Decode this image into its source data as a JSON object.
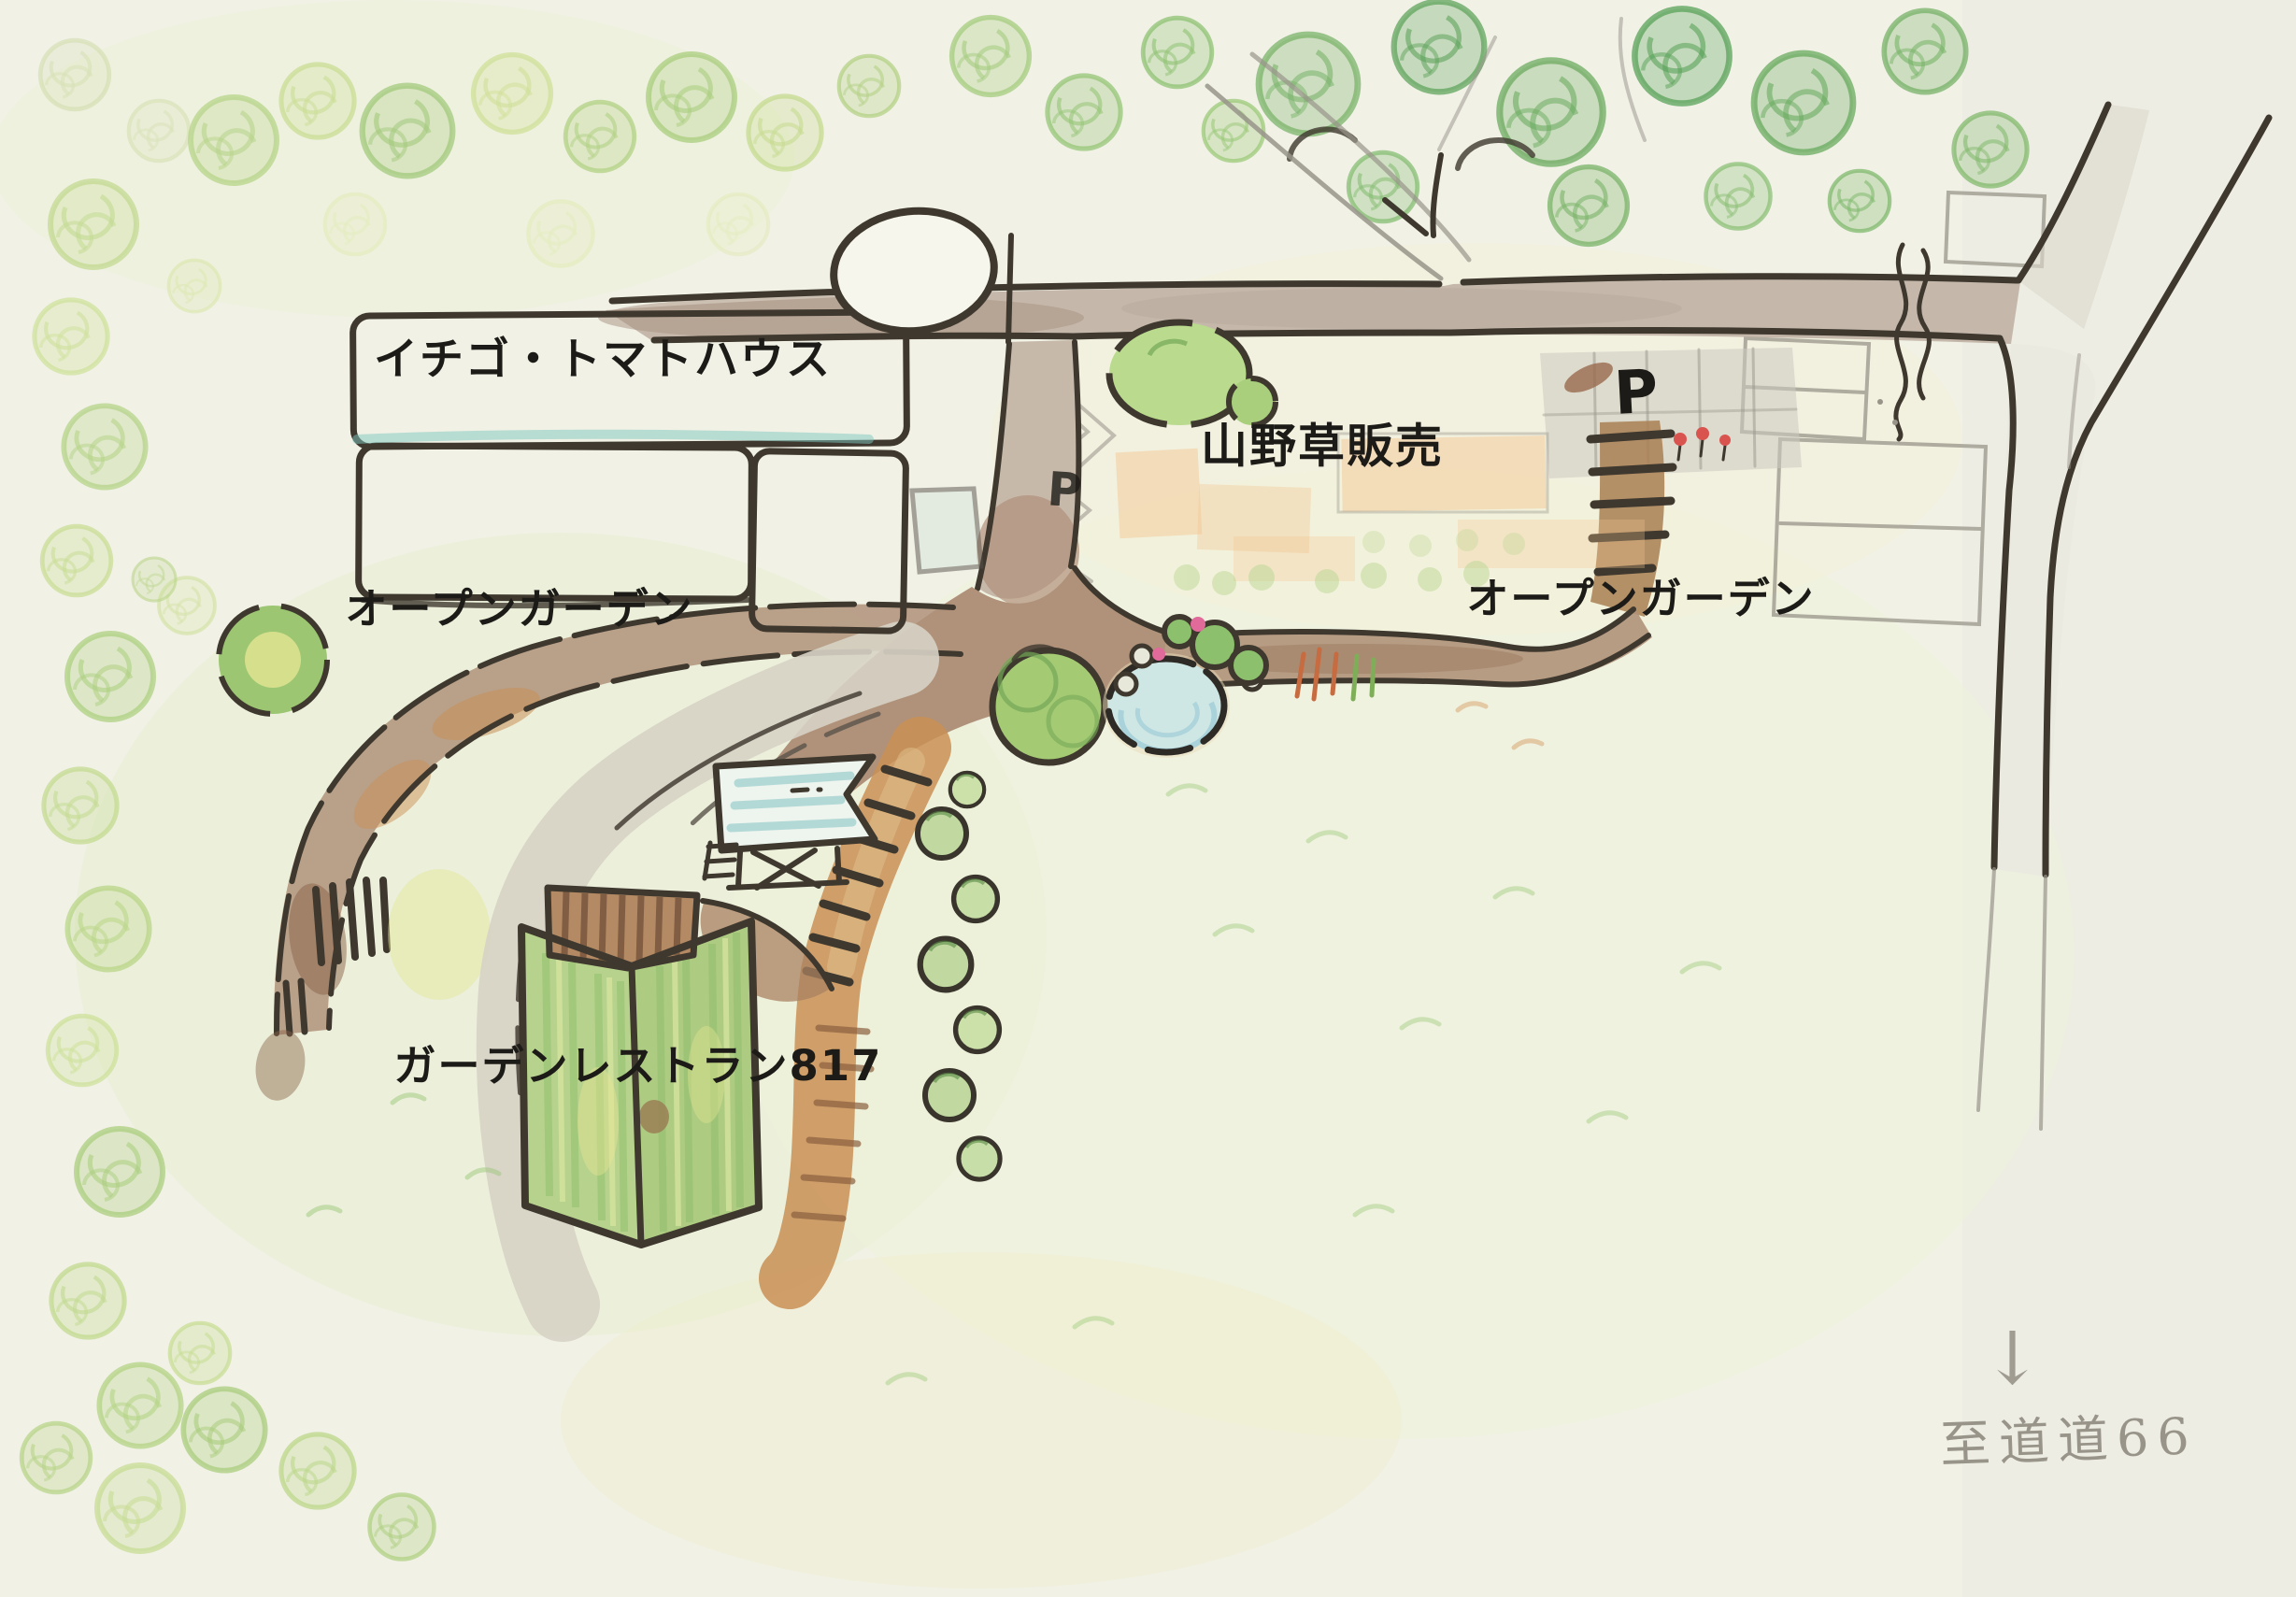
{
  "map_title": "hand-drawn garden site map",
  "labels": {
    "strawberry_tomato_house": "イチゴ・トマトハウス",
    "wild_plant_sales": "山野草販売",
    "open_garden_left": "オープンガーデン",
    "open_garden_right": "オープンガーデン",
    "garden_restaurant": "ガーデンレストラン817",
    "to_route_66": "至道道66",
    "parking_main": "P",
    "parking_small": "P"
  },
  "icons": {
    "down_arrow": "↓"
  },
  "colors": {
    "paper": "#f1f1e6",
    "ink": "#3e382e",
    "pencil": "#98948a",
    "label_ink": "#1d1b17",
    "road_fill": "#c0b1a4",
    "road_fill_light": "#dcd8cc",
    "path_brown": "#b0927a",
    "path_orange": "#c98f55",
    "path_gray": "#d7d3c5",
    "steps_brown": "#a97f52",
    "parking_gray": "#ccc9bf",
    "greenhouse_bg": "#f8f7ec",
    "greenhouse_blue": "#cfe6dd",
    "greenhouse_yellow": "#f0e8a6",
    "teal": "#7ec8bd",
    "building_green": "#b7d28c",
    "building_green_dark": "#8fbf6e",
    "building_brown": "#b48a64",
    "pond_blue": "#cfe7e4",
    "pond_blue_dark": "#9fcdd8",
    "tree_light": "#bcd88c",
    "tree_mid": "#9cc474",
    "tree_dark": "#6aab60",
    "tree_yellow": "#e4e592",
    "lawn": "#e7efcf",
    "flower_red": "#d9534f",
    "flower_pink": "#e06a9a"
  }
}
